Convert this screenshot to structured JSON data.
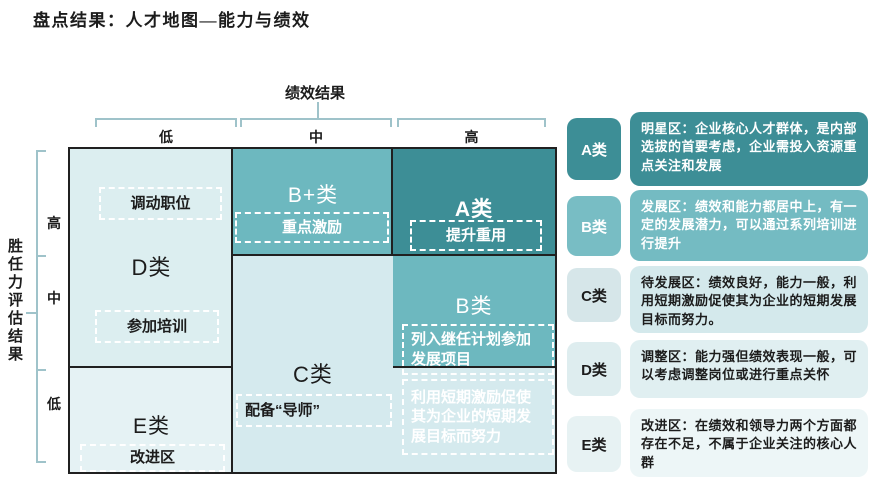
{
  "title": "盘点结果：人才地图—能力与绩效",
  "axes": {
    "x": {
      "title": "绩效结果",
      "ticks": [
        "低",
        "中",
        "高"
      ]
    },
    "y": {
      "title": "胜任力评估结果",
      "ticks": [
        "高",
        "中",
        "低"
      ]
    }
  },
  "matrix": {
    "a": {
      "label": "A类",
      "tag1": "提升重用"
    },
    "bplus": {
      "label": "B+类",
      "tag1": "重点激励"
    },
    "b": {
      "label": "B类",
      "tag1": "列入继任计划参加发展项目",
      "tag2": "利用短期激励促使其为企业的短期发展目标而努力"
    },
    "c": {
      "label": "C类",
      "tag1": "配备“导师”"
    },
    "d": {
      "label": "D类",
      "tag1": "调动职位",
      "tag2": "参加培训"
    },
    "e": {
      "label": "E类",
      "tag1": "改进区"
    }
  },
  "legend": [
    {
      "badge": "A类",
      "desc": "明星区：企业核心人才群体，是内部选拔的首要考虑，企业需投入资源重点关注和发展"
    },
    {
      "badge": "B类",
      "desc": "发展区：绩效和能力都居中上，有一定的发展潜力，可以通过系列培训进行提升"
    },
    {
      "badge": "C类",
      "desc": "待发展区：绩效良好，能力一般，利用短期激励促使其为企业的短期发展目标而努力。"
    },
    {
      "badge": "D类",
      "desc": "调整区：能力强但绩效表现一般，可以考虑调整岗位或进行重点关怀"
    },
    {
      "badge": "E类",
      "desc": "改进区：在绩效和领导力两个方面都存在不足，不属于企业关注的核心人群"
    }
  ],
  "colors": {
    "teal_dark": "#3d8e96",
    "teal_mid": "#6db8bf",
    "cell_light": "#d5eaee",
    "cell_lighter": "#dceef0",
    "cell_lightest": "#e5f2f4",
    "border_black": "#202020",
    "bracket_line": "#9fc3ca"
  }
}
